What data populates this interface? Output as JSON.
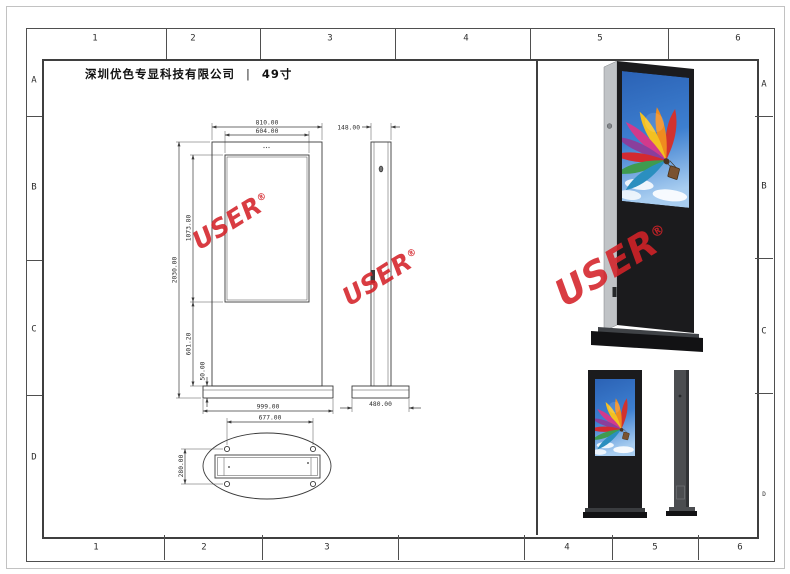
{
  "sheet": {
    "company": "深圳优色专显科技有限公司",
    "separator": "|",
    "product": "49寸"
  },
  "grid": {
    "top": [
      "1",
      "2",
      "3",
      "4",
      "5",
      "6"
    ],
    "bottom": [
      "1",
      "2",
      "3",
      "4",
      "5",
      "6"
    ],
    "left": [
      "A",
      "B",
      "C",
      "D"
    ],
    "right": [
      "A",
      "B",
      "C",
      "D"
    ]
  },
  "dims": {
    "front_width": "810.00",
    "screen_width": "604.00",
    "overall_height": "2030.00",
    "screen_height": "1073.80",
    "lower_height": "601.20",
    "base_height": "50.00",
    "base_width": "999.00",
    "side_depth": "148.00",
    "side_base_depth": "480.00",
    "bolt_span_width": "677.00",
    "bolt_span_depth": "280.00"
  },
  "watermark": {
    "text": "USER",
    "reg": "®",
    "color": "#d42228"
  },
  "colors": {
    "line": "#3a3a3a",
    "kiosk_black": "#1b1b1d",
    "kiosk_side_gray": "#c0c3c6",
    "sky_blue": "#3d7fd0"
  }
}
